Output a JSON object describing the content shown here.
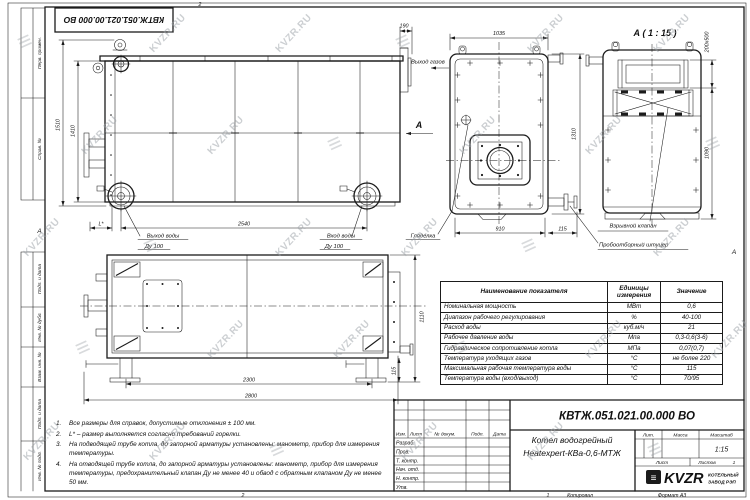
{
  "sheet": {
    "doc_number": "КВТЖ.051.021.00.000 ВО",
    "copied_note": "Копировал",
    "format_note": "Формат А3",
    "zone_top": "2",
    "zone_bottom_left": "2",
    "zone_bottom_right": "1",
    "zone_left": "А",
    "zone_right": "А"
  },
  "frame": {
    "left_labels": [
      "Перв. примен.",
      "Справ. №",
      "Подп. и дата",
      "Инв. № дубл.",
      "Взам. инв. №",
      "Подп. и дата",
      "Инв. № подл."
    ]
  },
  "watermark": {
    "text": "KVZR.RU",
    "glyph": "≡"
  },
  "views": {
    "front": {
      "dim_height_total": "1510",
      "dim_height_body": "1410",
      "dim_chimney": "190",
      "dim_length": "2540",
      "dim_burner": "L*",
      "label_water_out_1": "Выход воды",
      "label_water_out_2": "Ду 100",
      "label_water_in_1": "Вход воды",
      "label_water_in_2": "Ду 100",
      "label_gas_out": "Выход газов",
      "marker_a": "А"
    },
    "end": {
      "dim_width": "1035",
      "dim_height": "1310",
      "dim_base": "910",
      "dim_offset": "115",
      "label_sight": "Гляделка"
    },
    "detail": {
      "title": "А ( 1 : 15 )",
      "dim_valve": "200x500",
      "dim_height": "1090",
      "label_valve": "Взрывной клапан",
      "label_sampler": "Пробоотборный штуцер"
    },
    "side": {
      "dim_legs": "2300",
      "dim_total": "2800",
      "dim_height": "1110",
      "dim_foot": "115"
    }
  },
  "table": {
    "col_name": "Наименование показателя",
    "col_units": "Единицы измерения",
    "col_value": "Значение",
    "rows": [
      {
        "name": "Номинальная мощность",
        "units": "МВт",
        "value": "0,6"
      },
      {
        "name": "Диапазон рабочего регулирования",
        "units": "%",
        "value": "40-100"
      },
      {
        "name": "Расход воды",
        "units": "куб.м/ч",
        "value": "21"
      },
      {
        "name": "Рабочее давление воды",
        "units": "Мпа",
        "value": "0,3-0,6(3-6)"
      },
      {
        "name": "Гидравлическое сопротивление котла",
        "units": "МПа",
        "value": "0,07(0,7)"
      },
      {
        "name": "Температура уходящих газов",
        "units": "°С",
        "value": "не более 220"
      },
      {
        "name": "Максимальная рабочая температура воды",
        "units": "°С",
        "value": "115"
      },
      {
        "name": "Температура воды (вход/выход)",
        "units": "°С",
        "value": "70/95"
      }
    ]
  },
  "notes": {
    "items": [
      {
        "num": "1.",
        "text": "Все размеры для справок, допустимые отклонения ± 100 мм."
      },
      {
        "num": "2.",
        "text": "L* – размер выполняется согласно требований горелки."
      },
      {
        "num": "3.",
        "text": "На подводящей трубе котла, до запорной арматуры установлены: манометр, прибор для измерения температуры."
      },
      {
        "num": "4.",
        "text": "На отводящей трубе котла, до запорной арматуры установлены: манометр, прибор для измерения температуры, предохранительный клапан Ду не менее 40 и обвод с обратным клапаном Ду не менее 50 мм."
      }
    ]
  },
  "titleblock": {
    "doc_number": "КВТЖ.051.021.00.000 ВО",
    "product_line1": "Котел водогрейный",
    "product_line2": "Heatexpert-КВа-0,6-МТЖ",
    "cols": {
      "izm": "Изм.",
      "list": "Лист",
      "doc": "№ докум.",
      "sign": "Подп.",
      "date": "Дата"
    },
    "rows": [
      "Разраб.",
      "Пров.",
      "Т. контр.",
      "Нач. отд.",
      "Н. контр.",
      "Утв."
    ],
    "lit": "Лит.",
    "mass": "Масса",
    "scale_label": "Масштаб",
    "scale": "1:15",
    "sheet": "Лист",
    "sheets": "Листов",
    "sheets_value": "1",
    "company": {
      "abbr": "KVZR",
      "line1": "КОТЕЛЬНЫЙ",
      "line2": "ЗАВОД РЭП"
    }
  }
}
